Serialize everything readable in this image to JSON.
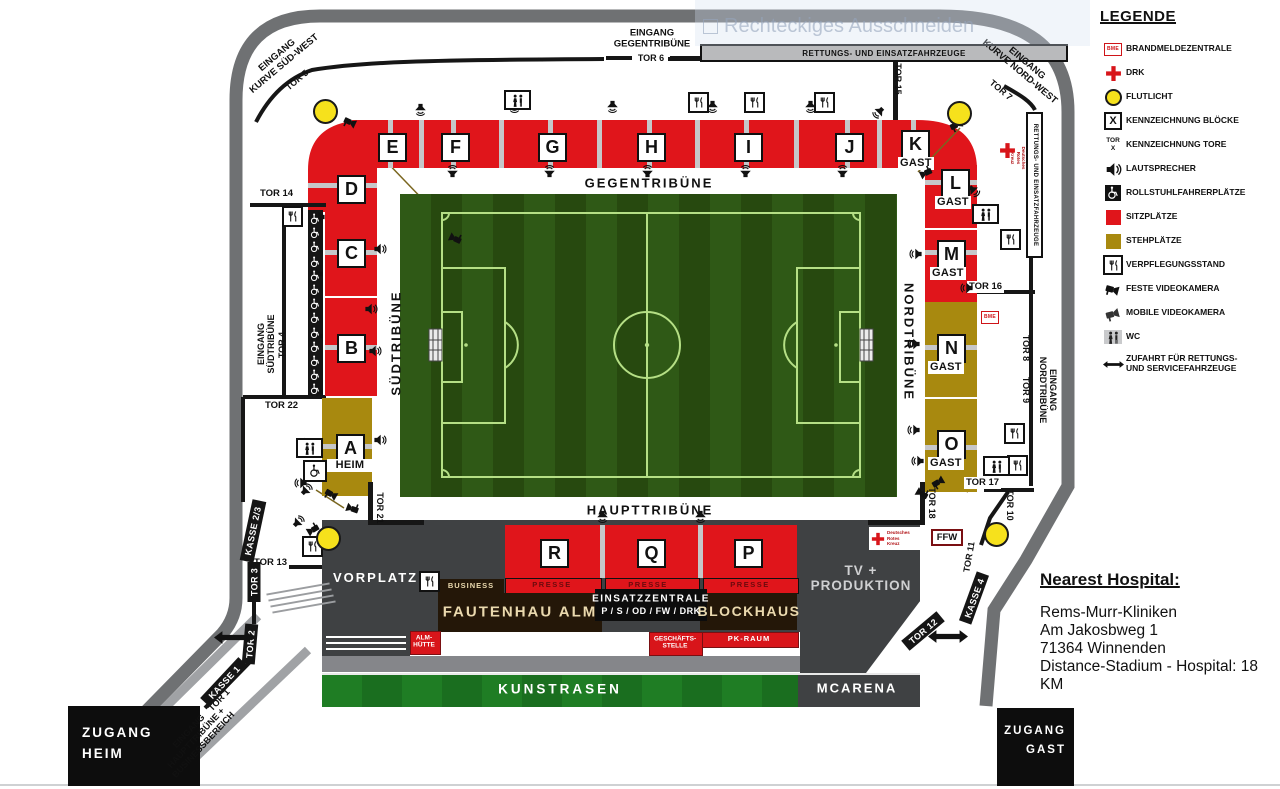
{
  "watermark": {
    "text": "Rechteckiges Ausschneiden"
  },
  "legend": {
    "title": "LEGENDE",
    "bme_text": "BME",
    "block_icon": "X",
    "tor_icon": "TOR\nX",
    "items": [
      {
        "icon": "bme-icon",
        "label": "BRANDMELDEZENTRALE"
      },
      {
        "icon": "red-cross-icon",
        "label": "DRK"
      },
      {
        "icon": "floodlight-icon",
        "label": "FLUTLICHT"
      },
      {
        "icon": "block-marker-icon",
        "label": "KENNZEICHNUNG BLÖCKE"
      },
      {
        "icon": "gate-marker-icon",
        "label": "KENNZEICHNUNG TORE"
      },
      {
        "icon": "speaker-icon",
        "label": "LAUTSPRECHER"
      },
      {
        "icon": "wheelchair-icon",
        "label": "ROLLSTUHLFAHRERPLÄTZE"
      },
      {
        "icon": "seat-square-icon",
        "label": "SITZPLÄTZE"
      },
      {
        "icon": "standing-square-icon",
        "label": "STEHPLÄTZE"
      },
      {
        "icon": "food-stand-icon",
        "label": "VERPFLEGUNGSSTAND"
      },
      {
        "icon": "fixed-camera-icon",
        "label": "FESTE VIDEOKAMERA"
      },
      {
        "icon": "mobile-camera-icon",
        "label": "MOBILE VIDEOKAMERA"
      },
      {
        "icon": "wc-icon",
        "label": "WC"
      },
      {
        "icon": "access-arrow-icon",
        "label": "ZUFAHRT FÜR RETTUNGS-\nUND SERVICEFAHRZEUGE"
      }
    ]
  },
  "tribunes": {
    "gegen": "GEGENTRIBÜNE",
    "haupt": "HAUPTTRIBÜNE",
    "sued": "SÜDTRIBÜNE",
    "nord": "NORDTRIBÜNE"
  },
  "blocks": {
    "a": "A",
    "b": "B",
    "c": "C",
    "d": "D",
    "e": "E",
    "f": "F",
    "g": "G",
    "h": "H",
    "i": "I",
    "j": "J",
    "k": "K",
    "l": "L",
    "m": "M",
    "n": "N",
    "o": "O",
    "p": "P",
    "q": "Q",
    "r": "R",
    "gast": "GAST",
    "heim": "HEIM"
  },
  "gates": {
    "g1": "TOR 1",
    "g2": "TOR 2",
    "g3": "TOR 3",
    "g4": "TOR 4",
    "g5": "TOR 5",
    "g6": "TOR 6",
    "g7": "TOR 7",
    "g8": "TOR 8",
    "g9": "TOR 9",
    "g10": "TOR 10",
    "g11": "TOR 11",
    "g12": "TOR 12",
    "g13": "TOR 13",
    "g14": "TOR 14",
    "g15": "TOR 15",
    "g16": "TOR 16",
    "g17": "TOR 17",
    "g18": "TOR 18",
    "g21": "TOR 21",
    "g22": "TOR 22"
  },
  "kassen": {
    "k1": "KASSE 1",
    "k23": "KASSE 2/3",
    "k4": "KASSE 4"
  },
  "entrances": {
    "sued_west": "EINGANG\nKURVE SÜD-WEST",
    "gegen": "EINGANG\nGEGENTRIBÜNE",
    "nord_west": "EINGANG\nKURVE NORD-WEST",
    "sued": "EINGANG\nSÜDTRIBÜNE",
    "nord": "EINGANG\nNORDTRIBÜNE",
    "haupt": "EINGANG\nHAUPTTRIBÜNE +\nBUSINESSBEREICH"
  },
  "areas": {
    "vorplatz": "VORPLATZ",
    "business": "BUSINESS",
    "presse": "PRESSE",
    "fautenhau": "FAUTENHAU ALM",
    "blockhaus": "BLOCKHAUS",
    "einsatz_line1": "EINSATZZENTRALE",
    "einsatz_line2": "P / S / OD / FW / DRK",
    "almhuette": "ALM-\nHÜTTE",
    "geschaeftsstelle": "GESCHÄFTS-\nSTELLE",
    "pkraum": "PK-RAUM",
    "kunstrasen": "KUNSTRASEN",
    "mcarena": "MCARENA",
    "tv": "TV +\nPRODUKTION",
    "rettung": "RETTUNGS- UND EINSATZFAHRZEUGE",
    "ffw": "FFW",
    "drk": "Deutsches\nRotes\nKreuz"
  },
  "access": {
    "heim": "ZUGANG\nHEIM",
    "gast": "ZUGANG\nGAST"
  },
  "hospital": {
    "title": "Nearest Hospital:",
    "lines": [
      "Rems-Murr-Kliniken",
      "Am Jakosbweg 1",
      "71364 Winnenden",
      "Distance-Stadium - Hospital: 18 KM"
    ]
  },
  "colors": {
    "seat_red": "#e0151b",
    "stand_gold": "#a8890f",
    "road_gray": "#6f7173",
    "dark_gray": "#3f4143",
    "field_green": "#2f5916",
    "kunstrasen_green": "#1f7d24"
  }
}
